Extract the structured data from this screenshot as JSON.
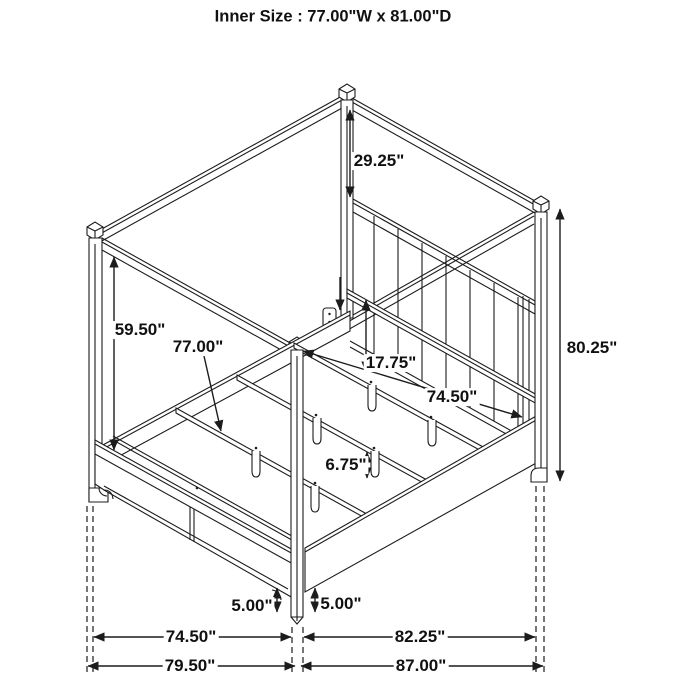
{
  "diagram": {
    "title": "Inner Size : 77.00\"W x 81.00\"D",
    "ink_color": "#1c1c1c",
    "background_color": "#ffffff",
    "labels": {
      "canopy_to_headboard": "29.25\"",
      "post_below_canopy": "59.50\"",
      "inner_width": "77.00\"",
      "deck_height": "17.75\"",
      "rail_inner_length": "74.50\"",
      "center_leg_height": "6.75\"",
      "overall_height": "80.25\"",
      "foot_clearance_front": "5.00\"",
      "foot_clearance_side": "5.00\"",
      "footboard_span": "74.50\"",
      "overall_width": "79.50\"",
      "siderail_span": "82.25\"",
      "overall_depth": "87.00\""
    }
  }
}
